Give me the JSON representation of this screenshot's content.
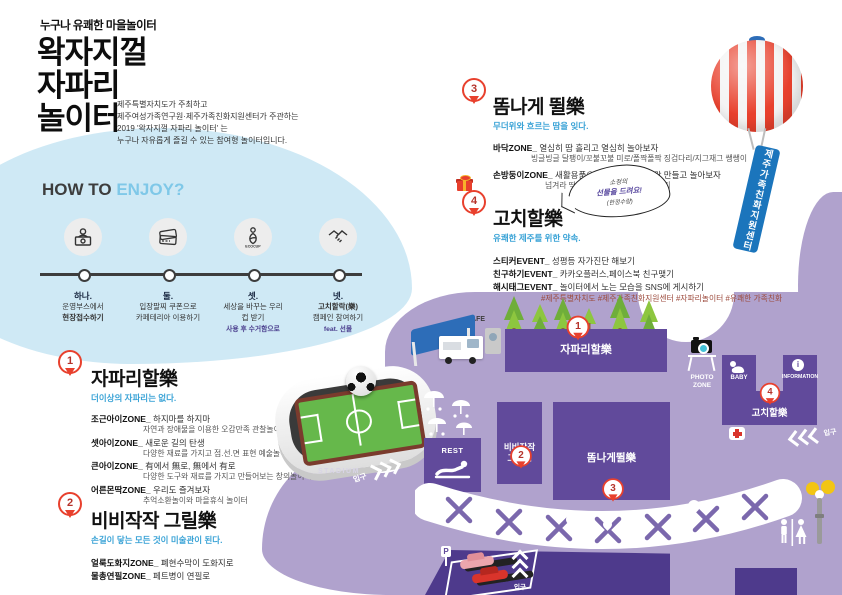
{
  "poster": {
    "tagline": "누구나 유쾌한 마을놀이터",
    "title_lines": [
      "왁자지껄",
      "자파리",
      "놀이터"
    ],
    "description_lines": [
      "제주특별자치도가 주최하고",
      "제주여성가족연구원·제주가족친화지원센터가 주관하는",
      "2019 '왁자지껄 자파리 놀이터' 는",
      "누구나 자유롭게 즐길 수 있는 참여형 놀이터입니다."
    ]
  },
  "how_to": {
    "title_dark": "HOW TO",
    "title_accent": "ENJOY?",
    "steps": [
      {
        "num": "하나.",
        "line1": "운영부스에서",
        "line2": "현장접수하기",
        "note": ""
      },
      {
        "num": "둘.",
        "line1": "입장팔찌 쿠폰으로",
        "line2": "카페테리아 이용하기",
        "note": ""
      },
      {
        "num": "셋.",
        "line1": "세상을 바꾸는 우리",
        "line2": "컵 받기",
        "note": "사용 후 수거함으로",
        "icon_label": "ECOCUP"
      },
      {
        "num": "넷.",
        "line1": "고치할락(樂)",
        "line2": "캠페인 참여하기",
        "note": "feat. 선물"
      }
    ]
  },
  "sections": [
    {
      "num": "1",
      "title": "자파리할樂",
      "subtitle": "더이상의 자파리는 없다.",
      "items": [
        {
          "zone": "조근아이ZONE_",
          "head": "하지마를 하지마",
          "desc": "자연과 장애물을 이용한 오감만족 관찰놀이터"
        },
        {
          "zone": "셋아이ZONE_",
          "head": "새로운 길의 탄생",
          "desc": "다양한 재료를 가지고 점.선.면 표현 예술놀이터"
        },
        {
          "zone": "큰아이ZONE_",
          "head": "有에서 無로, 無에서 有로",
          "desc": "다양한 도구와 재료를 가지고 만들어보는 창의놀이터"
        },
        {
          "zone": "어른몬딱ZONE_",
          "head": "우리도 즐겨보자",
          "desc": "추억소환놀이와 마을휴식 놀이터"
        }
      ]
    },
    {
      "num": "2",
      "title": "비비작작 그릴樂",
      "subtitle": "손길이 닿는 모든 것이 미술관이 된다.",
      "items": [
        {
          "zone": "얼룩도화지ZONE_",
          "head": "폐현수막이 도화지로",
          "desc": ""
        },
        {
          "zone": "물총연필ZONE_",
          "head": "페트병이 연필로",
          "desc": ""
        }
      ]
    },
    {
      "num": "3",
      "title": "똠나게 뛸樂",
      "subtitle": "무더위와 흐르는 땀을 잊다.",
      "items": [
        {
          "zone": "바닥ZONE_",
          "head": "열심히 땀 흘리고 열심히 놀아보자",
          "desc": "빙글빙글 달팽이/꼬불꼬불 미로/폴짝폴짝 징검다리/지그재그 쌩쌩이"
        },
        {
          "zone": "손방둥이ZONE_",
          "head": "새활용품으로 큐티뽀짝 놀이감 만들고 놀아보자",
          "desc": "넘겨라 딱지/돌아라 뱅뱅이/날아라 제기"
        }
      ]
    },
    {
      "num": "4",
      "title": "고치할樂",
      "subtitle": "유쾌한 제주를 위한 약속.",
      "bubble_lines": [
        "소정의",
        "선물을 드려요!",
        "(한정수량)"
      ],
      "items": [
        {
          "zone": "스티커EVENT_",
          "head": "성평등 자가진단 해보기",
          "desc": ""
        },
        {
          "zone": "친구하기EVENT_",
          "head": "카카오플러스,페이스북 친구맺기",
          "desc": ""
        },
        {
          "zone": "해시태그EVENT_",
          "head": "놀이터에서 노는 모습을 SNS에 게시하기",
          "desc": "#제주특별자치도 #제주가족친화지원센터 #자파리놀이터 #유쾌한 가족친화"
        }
      ]
    }
  ],
  "balloon": {
    "banner_text": "제주가족친화지원센터"
  },
  "stadium": {
    "label": "STADIUM",
    "entrance": "입구"
  },
  "map": {
    "cafe_label": "CAFE",
    "rest_label": "REST",
    "photo_zone_line1": "PHOTO",
    "photo_zone_line2": "ZONE",
    "baby_label": "BABY",
    "info_label": "INFORMATION",
    "info_icon": "i",
    "parking_label": "P",
    "entrance_right": "입구",
    "entrance_bottom": "입구",
    "zones": [
      {
        "num": "1",
        "label": "자파리할樂"
      },
      {
        "num": "2",
        "label_line1": "비비작작",
        "label_line2": "그릴樂"
      },
      {
        "num": "3",
        "label": "똠나게뛸樂"
      },
      {
        "num": "4",
        "label": "고치할樂"
      }
    ]
  },
  "colors": {
    "accent_blue": "#3aa3d6",
    "title_accent_blue": "#7fc8e8",
    "pin_red": "#e8402d",
    "light_blue_blob": "#cfe9f5",
    "map_purple": "#b0a2cd",
    "zone_purple": "#614a9b",
    "deep_purple_band": "#4e3a8c",
    "banner_blue": "#1b75bc",
    "tree_green": "#8dc63f",
    "note_purple": "#4b3f8e",
    "hashtag_brown": "#9c4a3c"
  }
}
